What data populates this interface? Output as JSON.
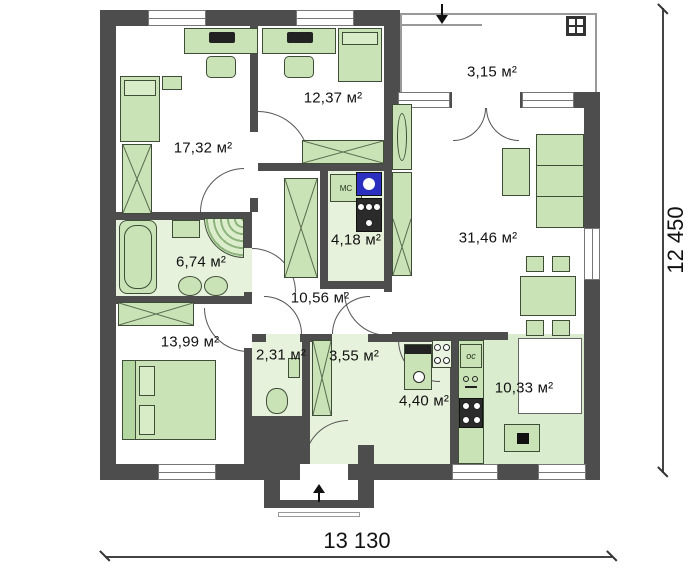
{
  "plan": {
    "rooms": [
      {
        "name": "bedroom-1",
        "area_label": "17,32 м²"
      },
      {
        "name": "bedroom-2",
        "area_label": "12,37 м²"
      },
      {
        "name": "terrace",
        "area_label": "3,15 м²"
      },
      {
        "name": "bathroom",
        "area_label": "6,74 м²"
      },
      {
        "name": "laundry",
        "area_label": "4,18 м²"
      },
      {
        "name": "living-room",
        "area_label": "31,46 м²"
      },
      {
        "name": "hallway",
        "area_label": "10,56 м²"
      },
      {
        "name": "bedroom-3",
        "area_label": "13,99 м²"
      },
      {
        "name": "wc",
        "area_label": "2,31 м²"
      },
      {
        "name": "hall",
        "area_label": "3,55 м²"
      },
      {
        "name": "boiler-room",
        "area_label": "4,40 м²"
      },
      {
        "name": "kitchen",
        "area_label": "10,33 м²"
      }
    ],
    "appliances": {
      "washer_slot_label": "МС",
      "fridge_label": "ос"
    },
    "dimensions": {
      "bottom_total": "13 130",
      "right_total": "12 450"
    },
    "colors": {
      "wall": "#4d4d4d",
      "furniture": "#c9e3b6",
      "furniture-border": "#3f4d38",
      "floor-tint": "#e7f2dd",
      "floor-tint2": "#d9ecce",
      "washer": "#2a2fc0",
      "line": "#555555"
    }
  }
}
